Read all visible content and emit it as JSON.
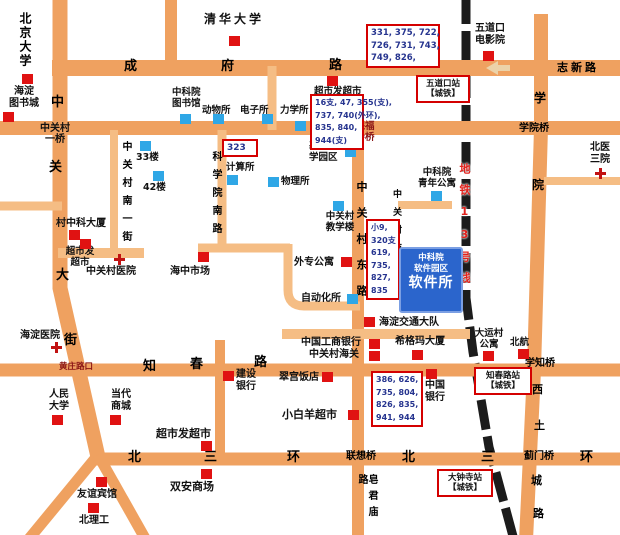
{
  "colors": {
    "road_major": "#efa160",
    "road_minor": "#f5bd84",
    "rail": "#1c1c1c",
    "marker_red": "#e01212",
    "marker_blue": "#2fa7e6",
    "box_border": "#d40000",
    "bus_text": "#26348f",
    "dark_red_text": "#8a1515",
    "hq_bg": "#2b65cc",
    "subway_text": "#e2211c"
  },
  "roads": {
    "chengfu": [
      "成",
      "府",
      "路"
    ],
    "zhixin_lu": "志新路",
    "zgc_dajie": [
      "中",
      "关",
      "大",
      "街"
    ],
    "xueyuan_lu": [
      "学",
      "院"
    ],
    "xitucheng_lu": [
      "西",
      "土",
      "城",
      "路"
    ],
    "zhichun_lu": [
      "知",
      "春",
      "路"
    ],
    "sanhuan_w": [
      "北",
      "三",
      "环"
    ],
    "sanhuan_e": [
      "北",
      "三",
      "环"
    ],
    "nanyijie": "中关村南一街",
    "kexueyuan_nanlu": "科学院南路",
    "donglu": "中关村东路",
    "nansijie": "中关村南四街",
    "zaojunmiao_lu": "皂君庙路",
    "subway13": "地铁13号线"
  },
  "bridges": {
    "yiqiao": "中关村\n一桥",
    "baofusi_qiao": "保福\n寺桥",
    "xueyuan_qiao": "学院桥",
    "xuezhi_qiao": "学知桥",
    "lianxiang_qiao": "联想桥",
    "jimen_qiao": "蓟门桥",
    "huangzhuang_lukou": "黄庄路口"
  },
  "stations": {
    "wudaokou": "五道口站\n【城铁】",
    "zhichunlu": "知春路站\n【城铁】",
    "dazhongsi": "大钟寺站\n【城铁】"
  },
  "bus_stops": {
    "chengfu_stop": "331, 375, 722,\n726, 731, 743,\n749, 826,",
    "baofusi_stop": "16支, 47, 355(支),\n737, 740(外环),\n835, 840,\n944(支)",
    "donglu_stop": "小9,\n320支\n619,\n735,\n827,\n835",
    "zhichun_stop": "386, 626,\n735, 804,\n826, 835,\n941, 944",
    "route_323": "323"
  },
  "hq": {
    "line1": "中科院",
    "line2": "软件园区",
    "line3": "软件所"
  },
  "pois": {
    "beijing_univ": "北京大学",
    "qinghua_univ": "清华大学",
    "haidian_book_city": "海淀\n图书城",
    "wudaokou_cinema": "五道口\n电影院",
    "cas_library": "中科院\n图书馆",
    "zoology_inst": "动物所",
    "electronics_inst": "电子所",
    "mechanics_inst": "力学所",
    "chaoshifa_north": "超市发超市",
    "building_33": "33楼",
    "building_42": "42楼",
    "computing_inst": "计算所",
    "physics_inst": "物理所",
    "basic_science_park": "基础科\n学园区",
    "zhongke_plaza": "村中科大厦",
    "chaoshifa_west": "超市发\n超市",
    "zgc_hospital": "中关村医院",
    "haizhong_market": "海中市场",
    "zgc_teaching_bldg": "中关村\n教学楼",
    "experts_apartment": "外专公寓",
    "automation_inst": "自动化所",
    "cas_youth_apartment": "中科院\n青年公寓",
    "beiyi_hospital": "北医\n三院",
    "traffic_brigade": "海淀交通大队",
    "icbc": "中国工商银行",
    "zgc_customs": "中关村海关",
    "sigma_plaza": "希格玛大厦",
    "cuigong_hotel": "翠宫饭店",
    "construction_bank": "建设\n银行",
    "xiaobaiyang": "小白羊超市",
    "bank_of_china": "中国\n银行",
    "dayuncun_apartment": "大运村\n公寓",
    "beihang": "北航",
    "haidian_hospital": "海淀医院",
    "renmin_univ": "人民\n大学",
    "dangdai_mall": "当代\n商城",
    "chaoshifa_south": "超市发超市",
    "shuangan_mall": "双安商场",
    "friendship_hotel": "友谊宾馆",
    "beiligong": "北理工"
  }
}
